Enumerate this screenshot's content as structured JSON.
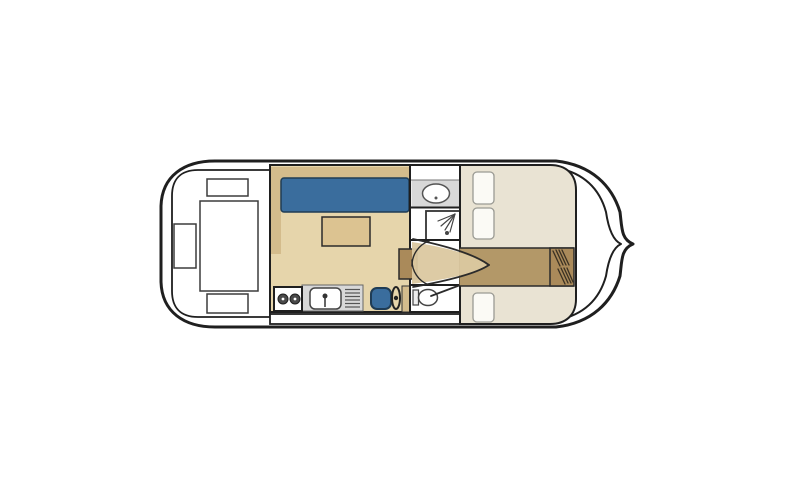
{
  "diagram": {
    "kind": "houseboat-floor-plan",
    "orientation": "bow-right",
    "sections": [
      {
        "name": "stern-deck",
        "features": [
          "deck-table",
          "deck-seat-top",
          "deck-seat-left",
          "deck-seat-bottom"
        ]
      },
      {
        "name": "saloon",
        "features": [
          "blue-sofa",
          "sofa-back-bench",
          "saloon-table"
        ]
      },
      {
        "name": "galley",
        "features": [
          "stove-two-burners",
          "sink-with-faucet",
          "drainer-rack"
        ]
      },
      {
        "name": "helm",
        "features": [
          "helm-chair",
          "steering-wheel",
          "console"
        ]
      },
      {
        "name": "bathroom",
        "features": [
          "washbasin",
          "shower",
          "toilet"
        ]
      },
      {
        "name": "corridor",
        "features": [
          "double-doors-open"
        ]
      },
      {
        "name": "bow-cabin",
        "features": [
          "double-bed",
          "single-bed",
          "pillows",
          "companionway-steps"
        ]
      }
    ]
  },
  "colors": {
    "hull": "#1f1f1f",
    "deck_white": "#ffffff",
    "floor_tan": "#e6d5ab",
    "sofa_back_tan": "#d4bc8c",
    "sofa_blue": "#3a6d9d",
    "sofa_border": "#1f3c55",
    "table_tan": "#dcc391",
    "counter_gray": "#d8d8d8",
    "burner_gray": "#4a4a4a",
    "cabin_cream": "#e9e3d3",
    "aisle_brown": "#b39868",
    "steps_brown": "#aa8a5a",
    "corridor_tan": "#dbc8a0",
    "pillow_white": "#fbfaf5",
    "furniture_border": "#3c3c3c",
    "line_dark": "#2b2b2b",
    "hatch_dark": "#3a3123"
  }
}
